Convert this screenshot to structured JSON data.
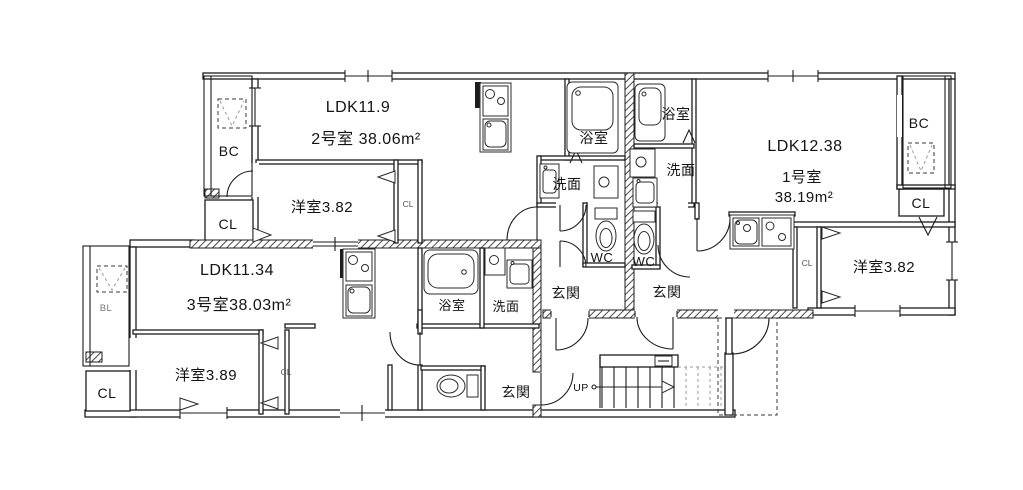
{
  "colors": {
    "background": "#ffffff",
    "line": "#1c1c1c"
  },
  "units": {
    "unit1": {
      "ldk_label": "LDK12.38",
      "name_label": "1号室",
      "area_label": "38.19m²",
      "bedroom_label": "洋室3.82",
      "balcony_label": "BC",
      "closet_label": "CL",
      "closet_small_label": "CL",
      "bath_label": "浴室",
      "washroom_label": "洗面",
      "toilet_label": "WC",
      "entrance_label": "玄関"
    },
    "unit2": {
      "ldk_label": "LDK11.9",
      "name_area_label": "2号室 38.06m²",
      "bedroom_label": "洋室3.82",
      "balcony_label": "BC",
      "closet_label": "CL",
      "closet_small_label": "CL",
      "bath_label": "浴室",
      "washroom_label": "洗面",
      "toilet_label": "WC",
      "entrance_label": "玄関"
    },
    "unit3": {
      "ldk_label": "LDK11.34",
      "name_area_label": "3号室38.03m²",
      "bedroom_label": "洋室3.89",
      "balcony_label": "BL",
      "closet_label": "CL",
      "closet_small_label": "CL",
      "bath_label": "浴室",
      "washroom_label": "洗面",
      "entrance_label": "玄関"
    }
  },
  "common": {
    "stairs_up_label": "UP"
  }
}
